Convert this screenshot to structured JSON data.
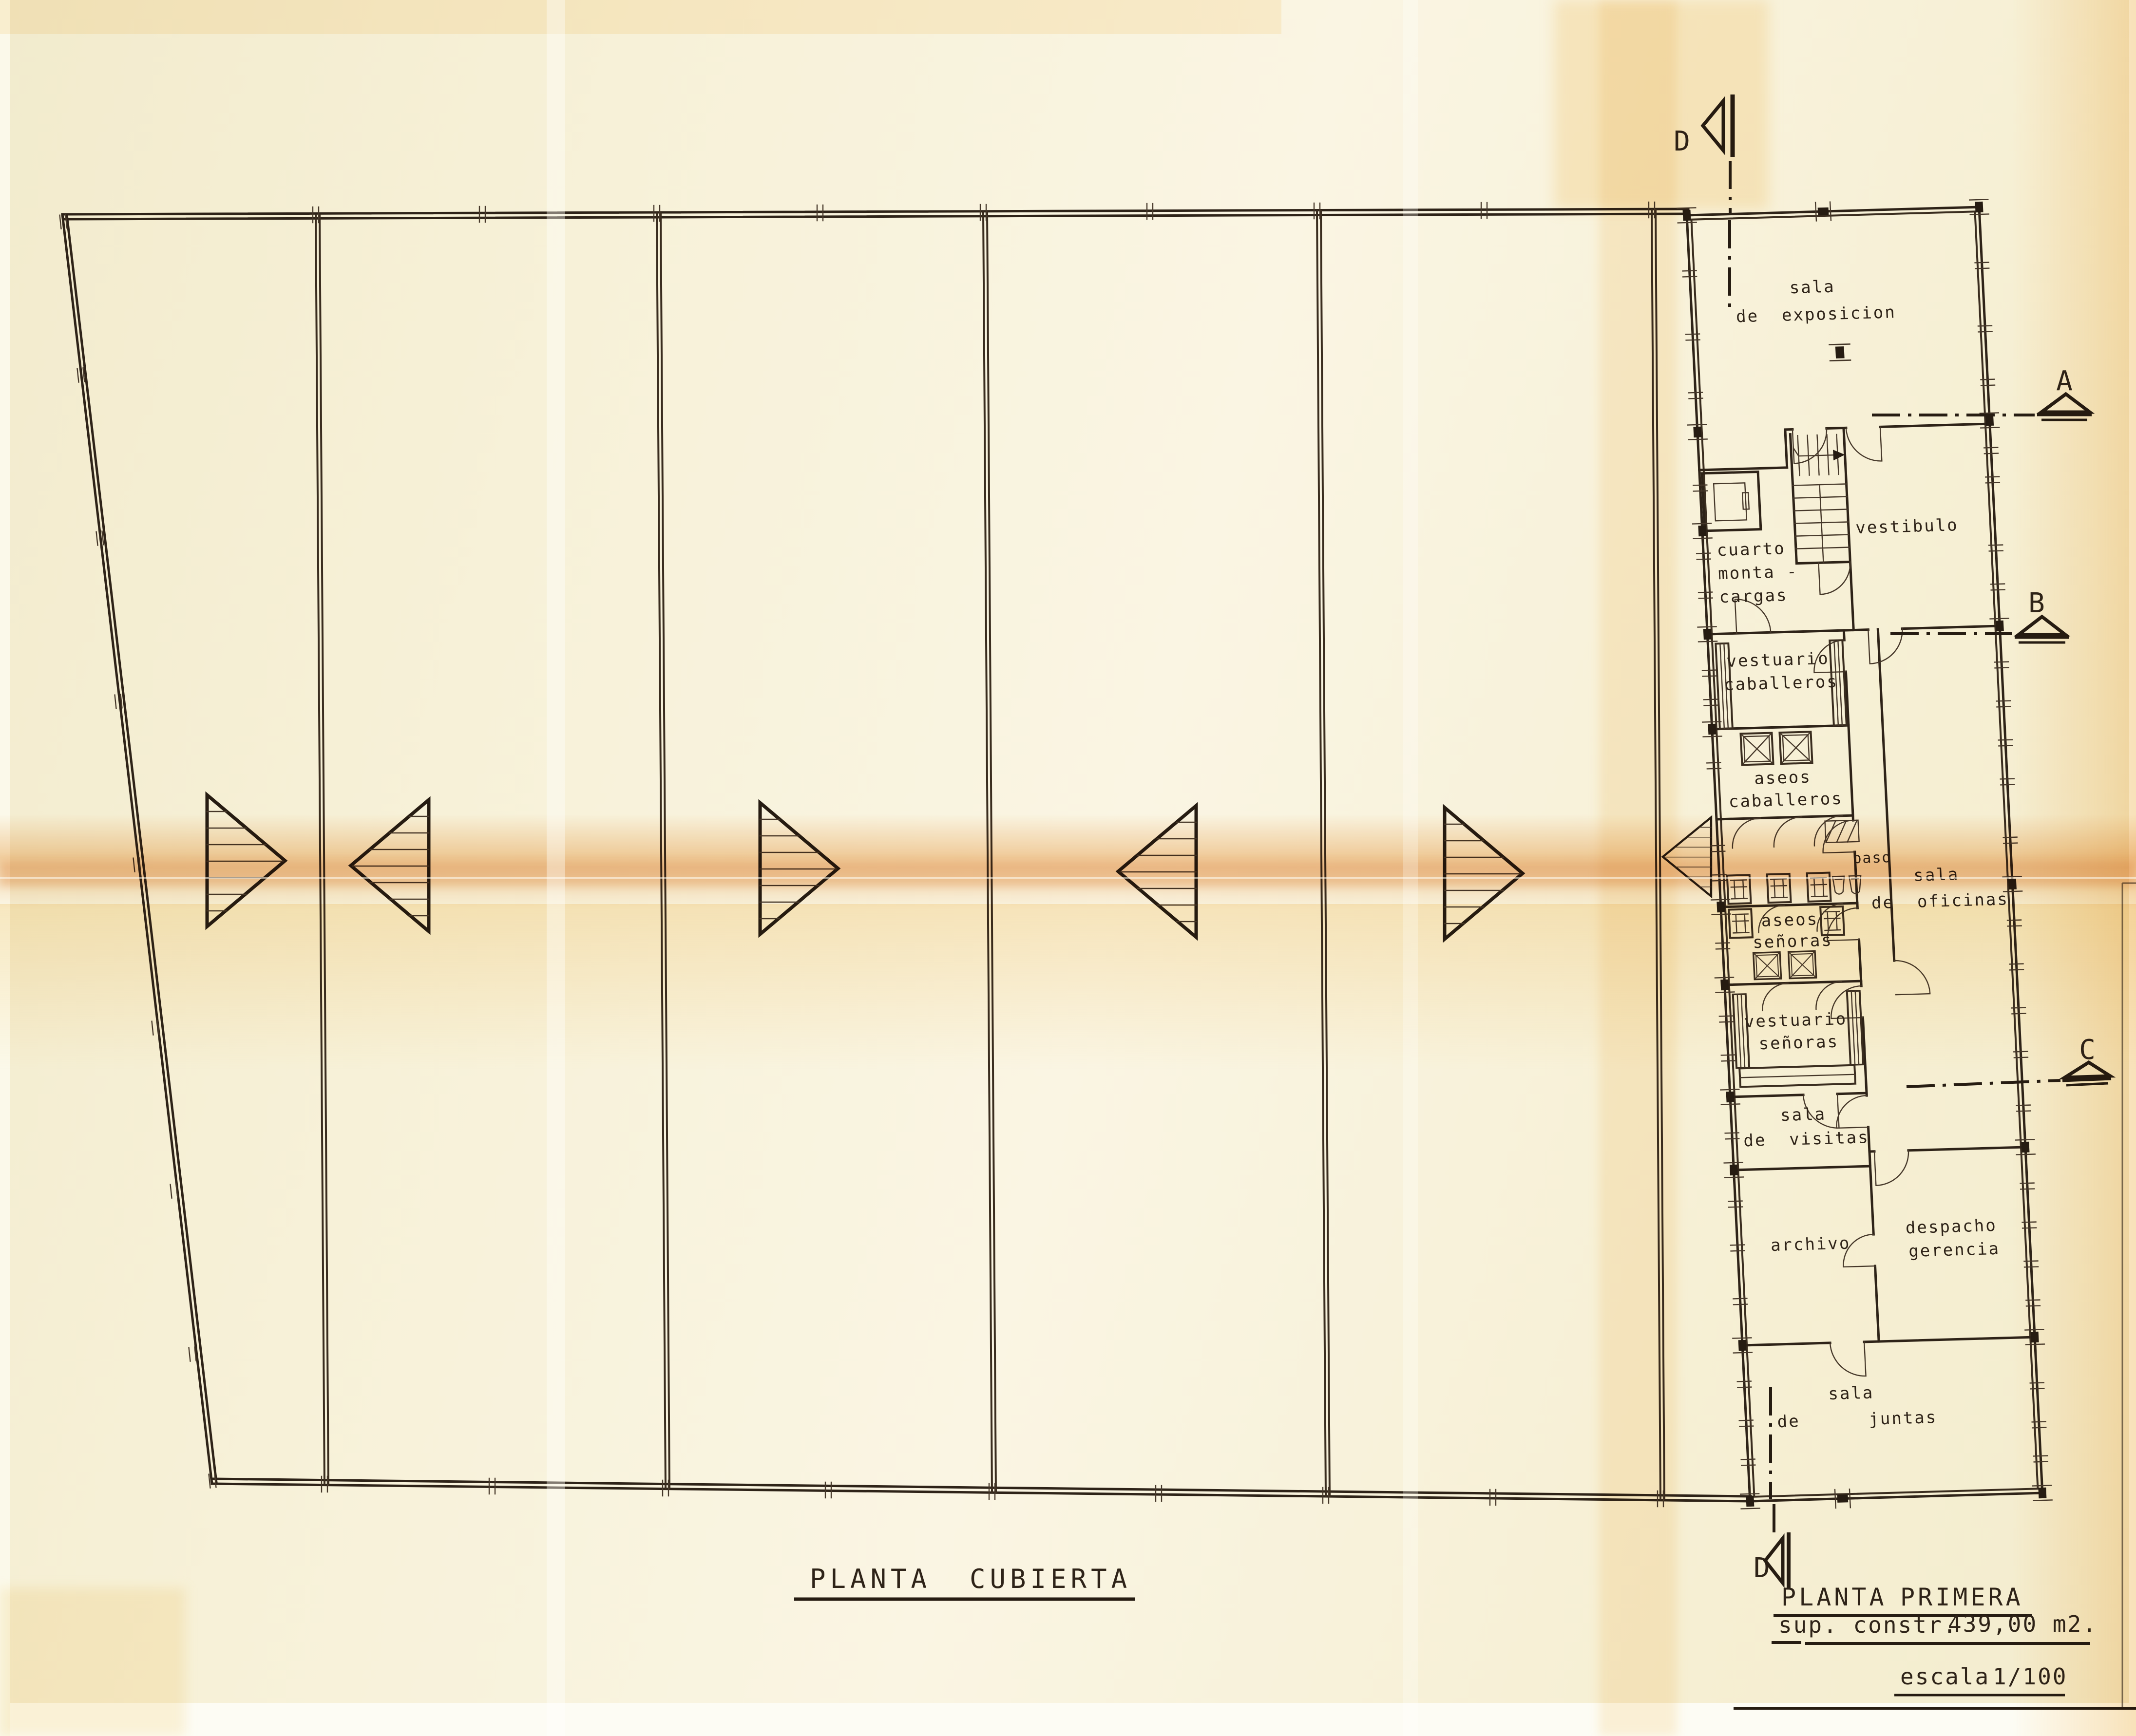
{
  "document": {
    "type": "architectural plan scan",
    "colors": {
      "ink": "#2e2318",
      "paper": "#f7f1d8",
      "fold_tint": "#e79436"
    }
  },
  "titles": {
    "left_plan_word1": "PLANTA",
    "left_plan_word2": "CUBIERTA",
    "right_plan_word1": "PLANTA",
    "right_plan_word2": "PRIMERA",
    "area_label": "sup. constr.",
    "area_value": "439,00 m2.",
    "scale_label": "escala",
    "scale_value": "1/100"
  },
  "markers": {
    "a": "A",
    "b": "B",
    "c": "C",
    "d": "D"
  },
  "rooms": {
    "sala_exposicion": [
      "sala",
      "de  exposicion"
    ],
    "cuarto_montacargas": [
      "cuarto",
      "monta -",
      "cargas"
    ],
    "vestibulo": [
      "vestibulo"
    ],
    "vestuario_caballeros": [
      "vestuario",
      "caballeros"
    ],
    "aseos_caballeros": [
      "aseos",
      "caballeros"
    ],
    "paso": [
      "paso"
    ],
    "sala_oficinas": [
      "sala",
      "de  oficinas"
    ],
    "aseos_senoras": [
      "aseos",
      "señoras"
    ],
    "vestuario_senoras": [
      "vestuario",
      "señoras"
    ],
    "sala_visitas": [
      "sala",
      "de  visitas"
    ],
    "archivo": [
      "archivo"
    ],
    "despacho_gerencia": [
      "despacho",
      "gerencia"
    ],
    "sala_juntas": [
      "sala",
      "de      juntas"
    ]
  }
}
